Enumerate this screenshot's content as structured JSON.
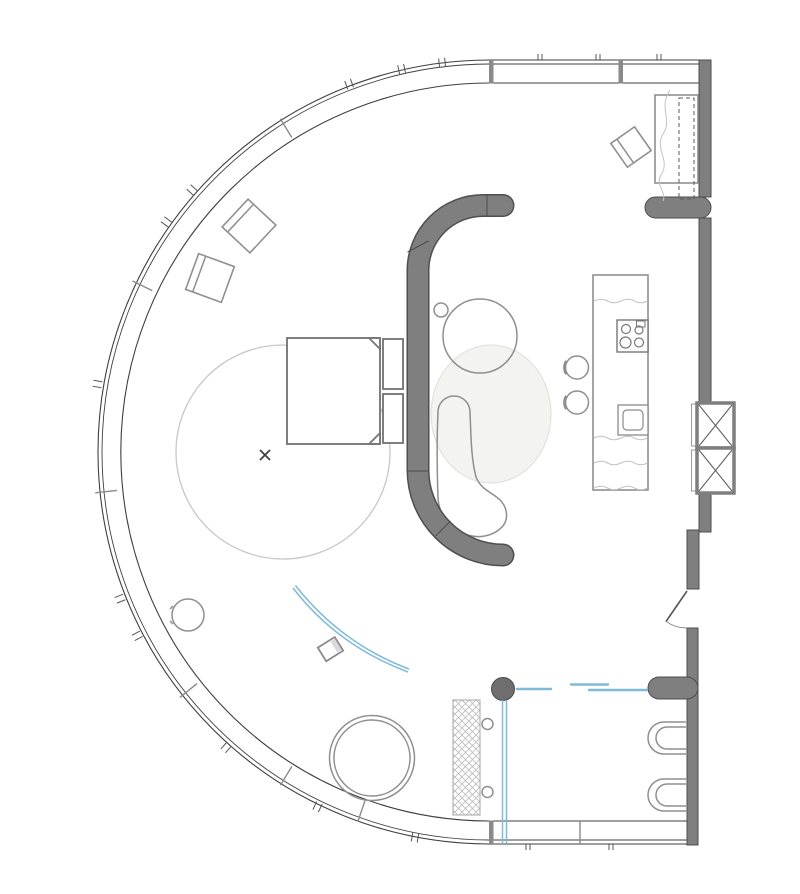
{
  "title": "Curved studio apartment floor plan",
  "document_type": "architectural floor plan drawing, top view, no text labels",
  "colors": {
    "background": "#ffffff",
    "line": "#3f3f3f",
    "wall": "#7f7f7f",
    "wall_edge": "#4c4c4c",
    "column": "#6e6e6e",
    "glass_mullion": "#8a8a8a",
    "furn": "#8f8f8f",
    "lite": "#c7c7c7",
    "rug_fill": "#f3f3f1",
    "rug_edge": "#ddddda",
    "accent": "#7fbad8",
    "hatch": "#bcbcbc"
  },
  "structure": {
    "facade": "continuous curved glazing band wrapping the left side, straight glazed bands at top and bottom, mullion divisions and tick marks",
    "right_wall": "thick grey wall with rounded-end partition stubs, two ventilation shafts with X-bracing, entry door swing, bathroom wall",
    "partition": "free-standing C-shaped grey partition with rounded ends separating sleeping area from lounge"
  },
  "rooms": [
    {
      "name": "sleeping-area",
      "items": [
        "double-bed",
        "two-pillows",
        "round-rug",
        "center-marker-x"
      ]
    },
    {
      "name": "lounge",
      "items": [
        "organic-rug",
        "coffee-table",
        "small-side-table",
        "chaise-lounge"
      ]
    },
    {
      "name": "kitchen",
      "items": [
        "island-counter",
        "four-burner-hob",
        "sink",
        "bar-stool",
        "bar-stool"
      ]
    },
    {
      "name": "guest-corner",
      "items": [
        "single-bed-wavy-blanket",
        "dashed-wardrobe",
        "tilted-armchair"
      ]
    },
    {
      "name": "winter-garden",
      "items": [
        "lounge-chair",
        "lounge-chair",
        "planter",
        "dining-table",
        "floor-plant"
      ]
    },
    {
      "name": "bathroom",
      "items": [
        "shower-column",
        "glass-screens-blue",
        "sliding-door-blue",
        "radiator-hatched",
        "wall-hung-toilet",
        "wall-hung-toilet",
        "door-knob",
        "door-knob"
      ]
    },
    {
      "name": "entry",
      "items": [
        "swing-door"
      ]
    }
  ],
  "annotations": {
    "center_marker": "x-cross at rug centre",
    "curtain": "blue curved curtain track with small media box"
  }
}
